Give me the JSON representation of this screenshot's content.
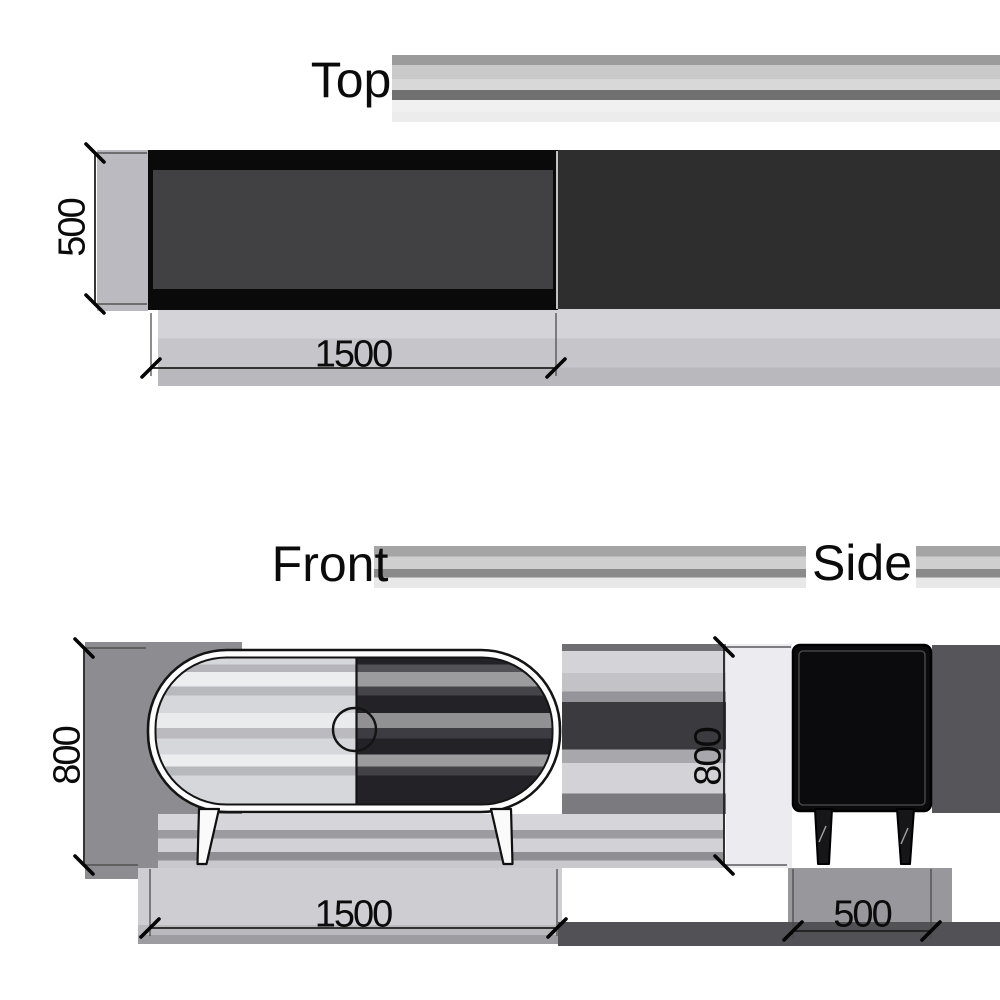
{
  "titles": {
    "top": "Top",
    "front": "Front",
    "side": "Side"
  },
  "dimensions": {
    "top_depth": "500",
    "top_width": "1500",
    "front_height": "800",
    "front_width": "1500",
    "side_height": "800",
    "side_width": "500"
  },
  "theme": {
    "background": "#ffffff",
    "ink": "#141414",
    "text": "#0b0b0b",
    "panel_fill": "#414144",
    "smear_dark": "#2e2e2e",
    "side_fill": "#0b0b0d",
    "door_light": "#d6d7da",
    "door_dark": "#232327",
    "shadow_mid": "#8c8c91",
    "band_light": "#cdcdd2",
    "side_panel_light": "#ebebf0",
    "side_shadow": "#55555a",
    "floor_dark": "#515156",
    "dim_shadow": "#babac0"
  }
}
